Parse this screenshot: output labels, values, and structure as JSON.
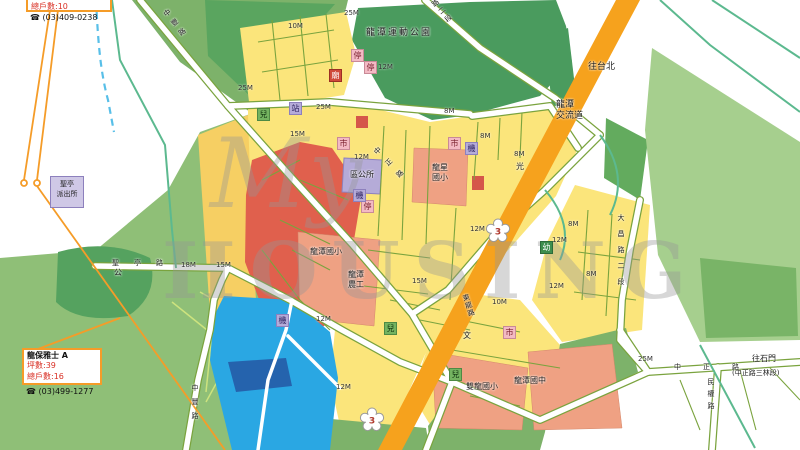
{
  "info_top": {
    "households": "總戶數:10",
    "phone_icon": "☎",
    "phone": "(03)409-0238"
  },
  "info_bottom": {
    "title": "龍保雅士 A",
    "area": "坪數:39",
    "households": "總戶數:16",
    "phone_icon": "☎",
    "phone": "(03)499-1277"
  },
  "watermark": {
    "script": "My",
    "block": "HOUSING"
  },
  "places": {
    "sports_park": "龍潭運動公園",
    "district_office": "區公所",
    "longxing_elem": "龍星\n國小",
    "longtan_elem": "龍潭國小",
    "longtan_agri": "龍潭\n農工",
    "shuanglong_elem": "雙龍國小",
    "longtan_jhs": "龍潭國中",
    "police_station": "聖亭\n派出所",
    "park_abbrev": "公"
  },
  "directions": {
    "to_taipei": "往台北",
    "interchange": "龍潭\n交流道",
    "to_shimen": "往石門",
    "to_shimen_sub": "(中正路三林段)"
  },
  "roads": {
    "zhongfeng": "中豐路",
    "zhongzheng": "中正路",
    "dachang": "大昌路二段",
    "donglong": "東龍路",
    "shengting": "聖亭路",
    "minquan": "民權路",
    "duan2": "路二段",
    "w8": "8M",
    "w10": "10M",
    "w12": "12M",
    "w15": "15M",
    "w18": "18M",
    "w25": "25M"
  },
  "markers": {
    "parking": "停",
    "market": "市",
    "utility": "機",
    "children": "兒",
    "kindergarten": "幼",
    "station": "站",
    "temple": "廟",
    "culture": "文",
    "guang": "光"
  },
  "route_shield": "3",
  "colors": {
    "highway": "#F6A21D",
    "pond": "#2AA7E3",
    "park_green": "#4A9B5E",
    "residential": "#FBE57B",
    "commercial": "#E0604D",
    "school": "#EFA183",
    "public": "#B5ABD8",
    "market_pink": "#F3BAC4",
    "accent_orange": "#F59C28",
    "stat_red": "#D93025"
  }
}
